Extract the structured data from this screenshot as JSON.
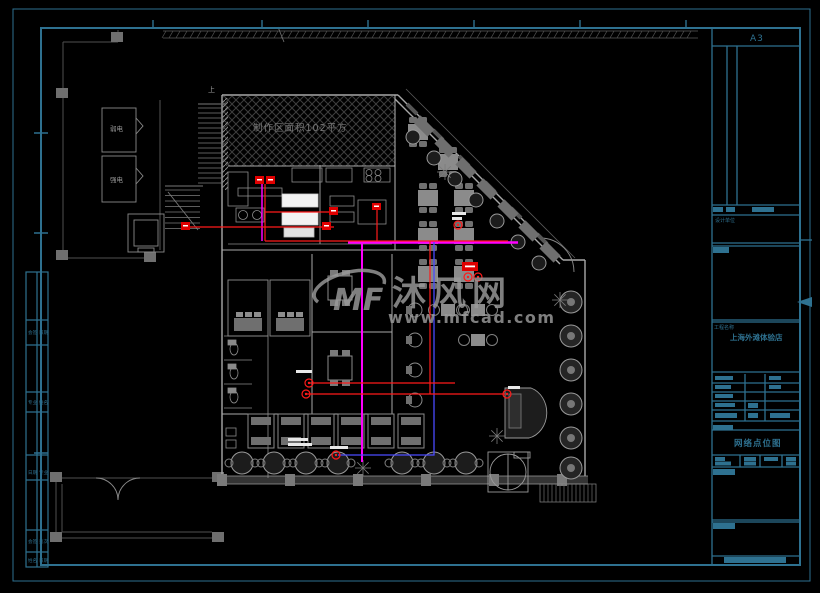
{
  "sheet": {
    "size_label": "A3"
  },
  "watermark": {
    "logo": "MF",
    "brand": "沐风网",
    "url": "www.mfcad.com"
  },
  "plan": {
    "hatch_area_label": "制作区面积102平方",
    "room_weak_power": "弱电",
    "room_strong_power": "强电",
    "stairs_up": "上"
  },
  "titleblock": {
    "sheet_size": "A3",
    "design_unit_label": "设计单位",
    "project_label": "工程名称",
    "project_name": "上海外滩体验店",
    "drawing_title": "网络点位图"
  },
  "left_strip": {
    "cells": [
      "会签",
      "专业",
      "姓名",
      "日期",
      "页次"
    ]
  }
}
